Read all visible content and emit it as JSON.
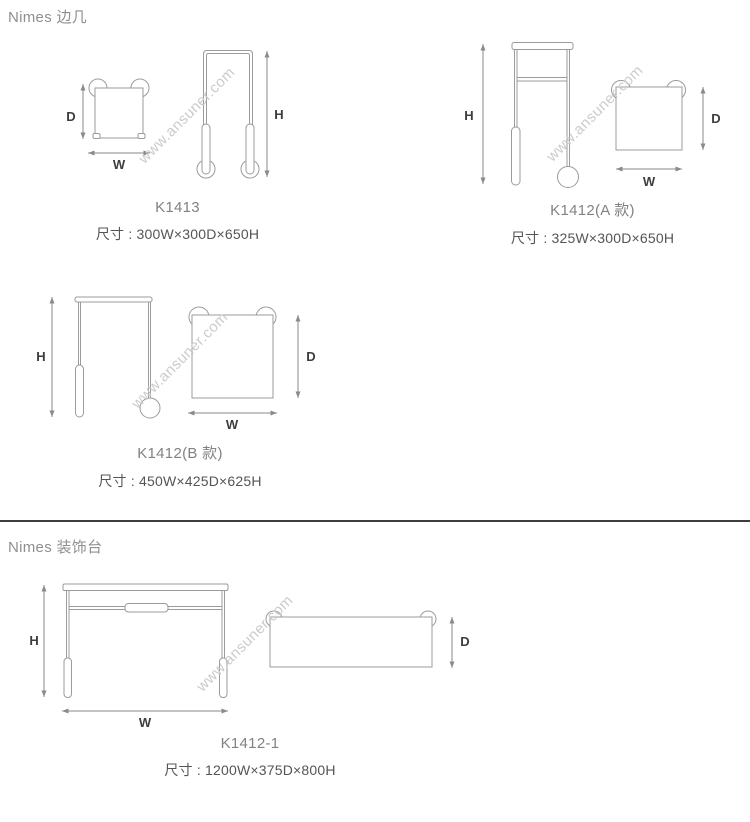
{
  "sections": [
    {
      "title": "Nimes 边几"
    },
    {
      "title": "Nimes 装饰台"
    }
  ],
  "dim_labels": {
    "d": "D",
    "w": "W",
    "h": "H"
  },
  "products": [
    {
      "id": "K1413",
      "name": "K1413",
      "dims": "尺寸 : 300W×300D×650H"
    },
    {
      "id": "K1412A",
      "name": "K1412(A 款)",
      "dims": "尺寸 : 325W×300D×650H"
    },
    {
      "id": "K1412B",
      "name": "K1412(B 款)",
      "dims": "尺寸 : 450W×425D×625H"
    },
    {
      "id": "K1412-1",
      "name": "K1412-1",
      "dims": "尺寸 : 1200W×375D×800H"
    }
  ],
  "watermark": {
    "text": "www.ansuner.com"
  }
}
